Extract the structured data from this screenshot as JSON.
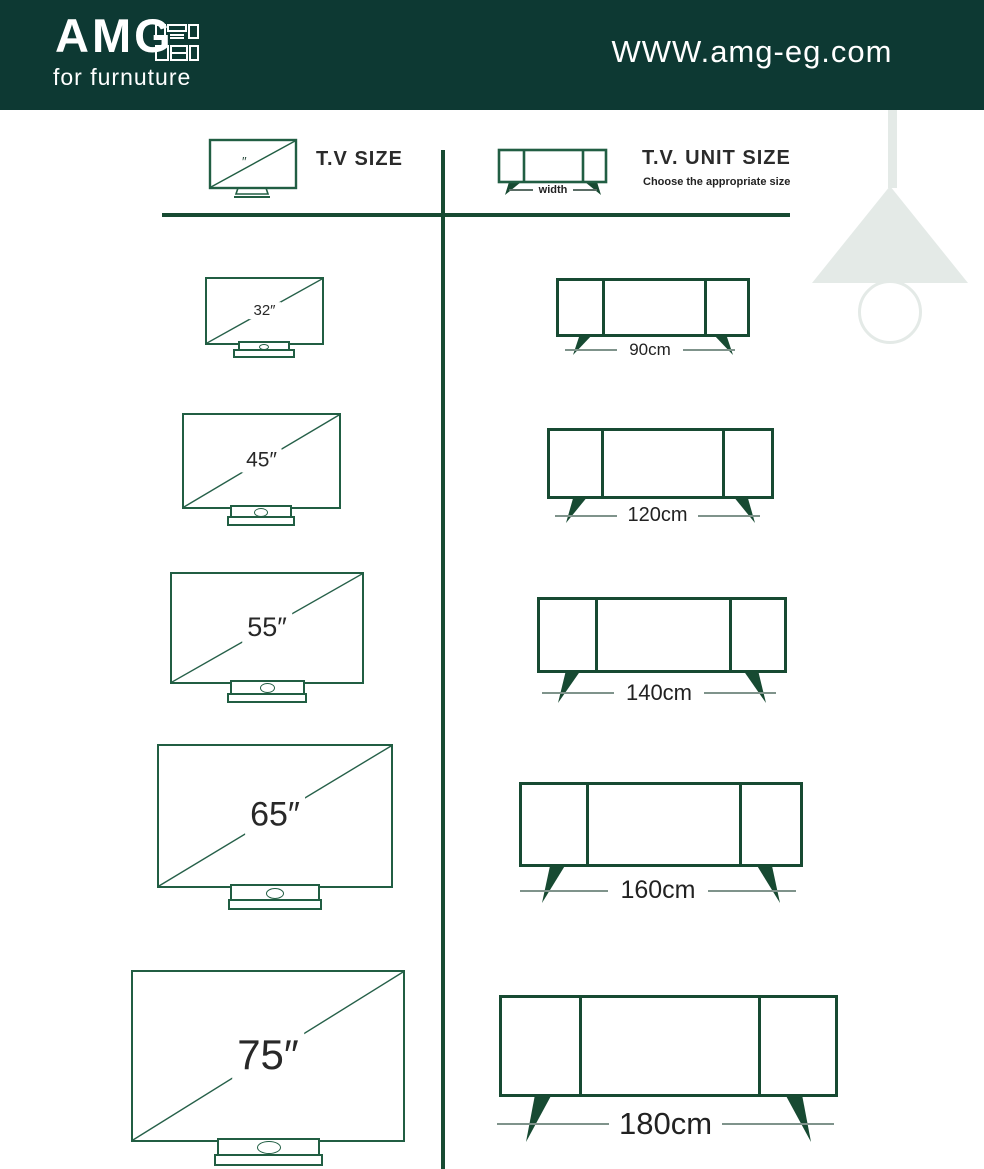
{
  "header": {
    "brand": "AMG",
    "tagline": "for furnuture",
    "website": "WWW.amg-eg.com"
  },
  "legend": {
    "tv_title": "T.V SIZE",
    "unit_title": "T.V. UNIT SIZE",
    "unit_subtitle": "Choose the appropriate size",
    "width_label": "width",
    "inch_mark": "″"
  },
  "rows": [
    {
      "tv_size": "32″",
      "unit_width": "90cm"
    },
    {
      "tv_size": "45″",
      "unit_width": "120cm"
    },
    {
      "tv_size": "55″",
      "unit_width": "140cm"
    },
    {
      "tv_size": "65″",
      "unit_width": "160cm"
    },
    {
      "tv_size": "75″",
      "unit_width": "180cm"
    }
  ],
  "icons": {
    "logo_cabinet_icon": "kitchen-cabinet outline glyph",
    "tv_icon": "television with stand outline",
    "tv_unit_icon": "tv sideboard with legs outline",
    "lamp_decoration": "hanging pendant lamp silhouette"
  },
  "colors": {
    "header_bg": "#0d3933",
    "tv_line_green": "#215e43",
    "unit_dark_green": "#174a32",
    "label_text": "#282828",
    "dash_gray": "#7f938b",
    "lamp_gray": "#e4eae7"
  }
}
